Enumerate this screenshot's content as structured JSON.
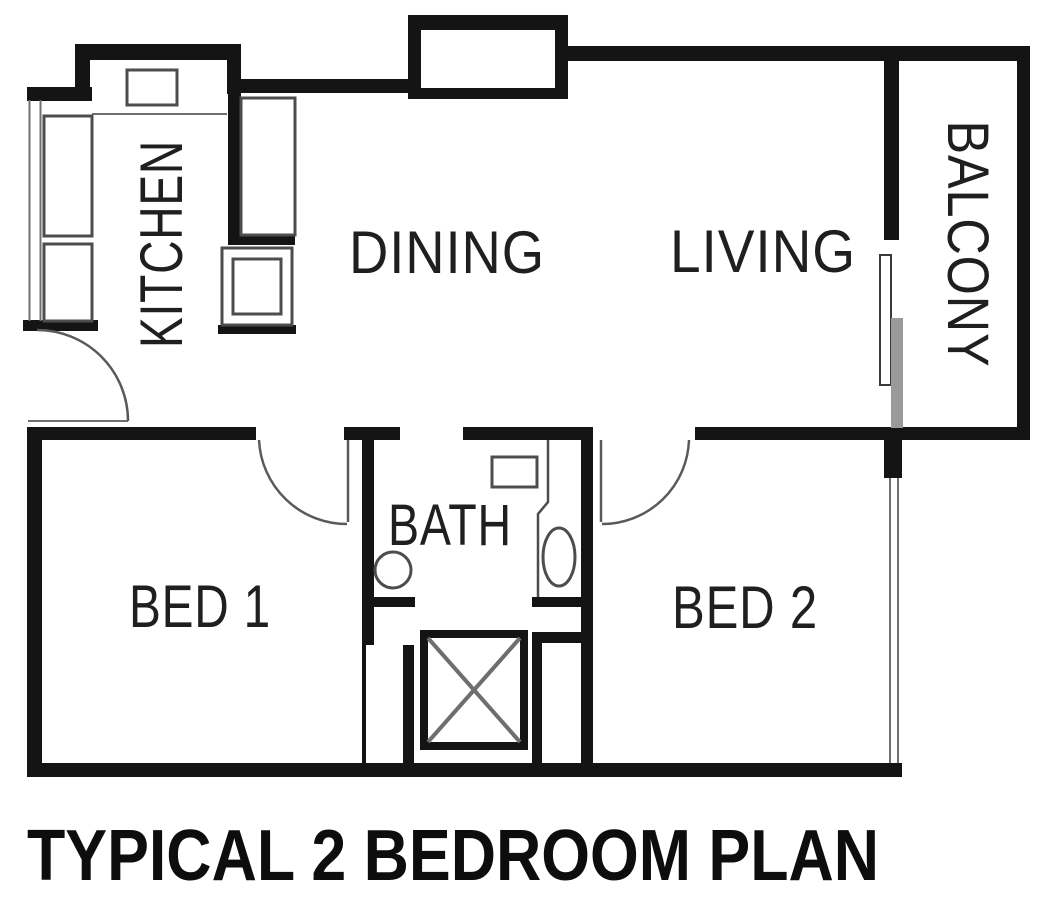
{
  "title": "TYPICAL 2 BEDROOM PLAN",
  "rooms": {
    "kitchen": "KITCHEN",
    "dining": "DINING",
    "living": "LIVING",
    "balcony": "BALCONY",
    "bed1": "BED 1",
    "bath": "BATH",
    "bed2": "BED 2"
  },
  "colors": {
    "wall": "#141414",
    "background": "#ffffff",
    "fixture_line": "#4d4d4d",
    "slider_panel": "#9a9a9a",
    "text": "#1f1f1f"
  }
}
